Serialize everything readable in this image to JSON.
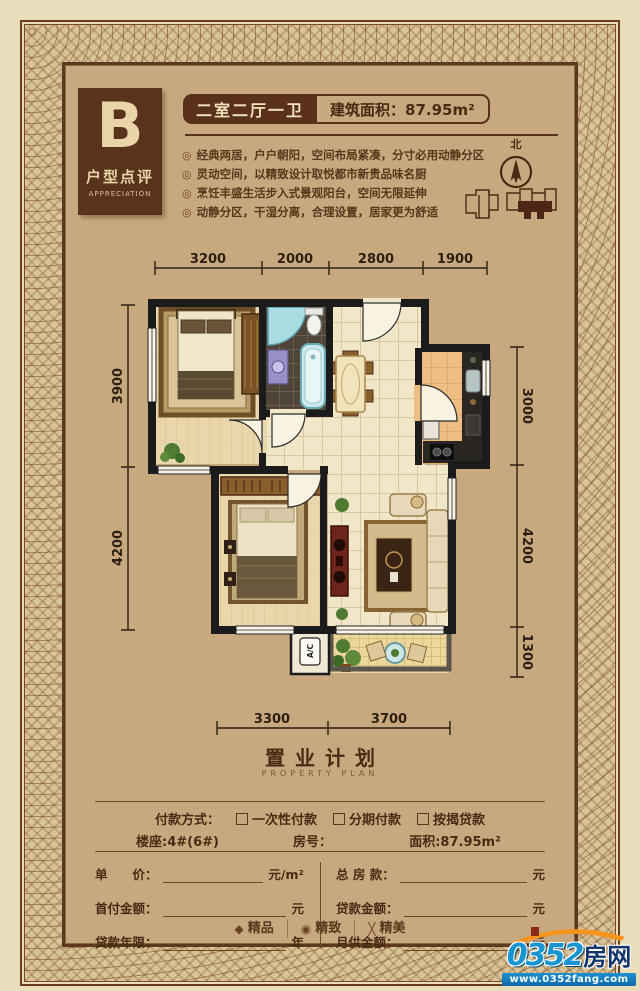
{
  "header": {
    "unit_letter": "B",
    "unit_title": "户型点评",
    "unit_subtitle": "APPRECIATION",
    "layout_title": "二室二厅一卫",
    "area_badge": "建筑面积：87.95m²",
    "bullet_icon": "◎",
    "bullets": [
      "经典两居，户户朝阳，空间布局紧凑，分寸必用动静分区",
      "灵动空间，以精致设计取悦都市新贵品味名厨",
      "烹饪丰盛生活步入式景观阳台，空间无限延伸",
      "动静分区，干湿分离，合理设置，居家更为舒适"
    ],
    "compass_label": "北"
  },
  "floorplan": {
    "dims_top": [
      "3200",
      "2000",
      "2800",
      "1900"
    ],
    "dims_left": [
      "3900",
      "4200"
    ],
    "dims_right": [
      "3000",
      "4200",
      "1300"
    ],
    "dims_bottom": [
      "3300",
      "3700"
    ],
    "ac_label": "A/C"
  },
  "property_plan": {
    "title": "置业计划",
    "subtitle": "PROPERTY PLAN",
    "payment_label": "付款方式：",
    "payment_options": [
      "一次性付款",
      "分期付款",
      "按揭贷款"
    ],
    "building": "楼座:4#(6#)",
    "room_no": "房号：",
    "area": "面积:87.95m²",
    "rows": [
      {
        "l": "单　　价：",
        "lu": "元/m²",
        "r": "总 房 款：",
        "ru": "元"
      },
      {
        "l": "首付金额：",
        "lu": "元",
        "r": "贷款金额：",
        "ru": "元"
      },
      {
        "l": "贷款年限：",
        "lu": "年",
        "r": "月供金额：",
        "ru": "元"
      }
    ]
  },
  "footer": {
    "badges": [
      {
        "icon": "◆",
        "label": "精品"
      },
      {
        "icon": "◉",
        "label": "精致"
      },
      {
        "icon": "╳",
        "label": "精美"
      }
    ],
    "logo": {
      "number": "0352",
      "name": "房网",
      "url": "www.0352fang.com"
    }
  },
  "colors": {
    "content_bg": "#c8a87e",
    "outer_bg": "#eaddbb",
    "dark_brown": "#5a321c",
    "text_brown": "#4a2a14",
    "wall_black": "#1b1b1b",
    "accent_blue": "#1795d2",
    "accent_orange": "#f7941d"
  }
}
